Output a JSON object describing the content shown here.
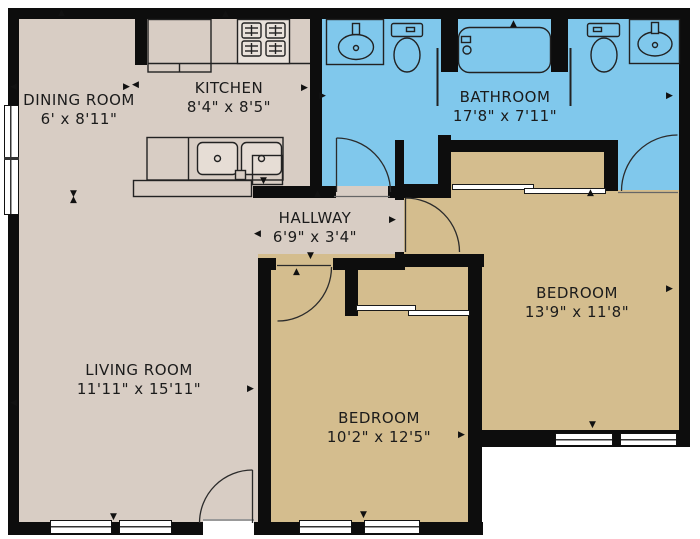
{
  "plan": {
    "title": "apartment-floor-plan",
    "rooms": {
      "dining": {
        "name": "DINING ROOM",
        "dims": "6' x 8'11\""
      },
      "kitchen": {
        "name": "KITCHEN",
        "dims": "8'4\" x 8'5\""
      },
      "bathroom": {
        "name": "BATHROOM",
        "dims": "17'8\" x 7'11\""
      },
      "hallway": {
        "name": "HALLWAY",
        "dims": "6'9\" x 3'4\""
      },
      "living": {
        "name": "LIVING ROOM",
        "dims": "11'11\" x 15'11\""
      },
      "bedroom_right": {
        "name": "BEDROOM",
        "dims": "13'9\" x 11'8\""
      },
      "bedroom_bottom": {
        "name": "BEDROOM",
        "dims": "10'2\" x 12'5\""
      }
    },
    "glyphs": {
      "up": "▲",
      "down": "▼",
      "left": "◀",
      "right": "▶"
    },
    "colors": {
      "wall": "#0d0d0d",
      "floor_main": "#d8cdc4",
      "floor_bedroom": "#d4bd8e",
      "floor_bathroom": "#80c8ec",
      "window": "#ffffff",
      "fixture_outline": "#222222",
      "label_text": "#1b1b1b"
    },
    "fixtures": [
      "refrigerator",
      "stove",
      "kitchen-double-sink",
      "dishwasher",
      "counter-peninsula",
      "vanity-sink-left",
      "toilet-left",
      "bathtub",
      "toilet-right",
      "vanity-sink-right",
      "linen-closet",
      "sliding-door-closet",
      "hinged-door",
      "window"
    ]
  }
}
